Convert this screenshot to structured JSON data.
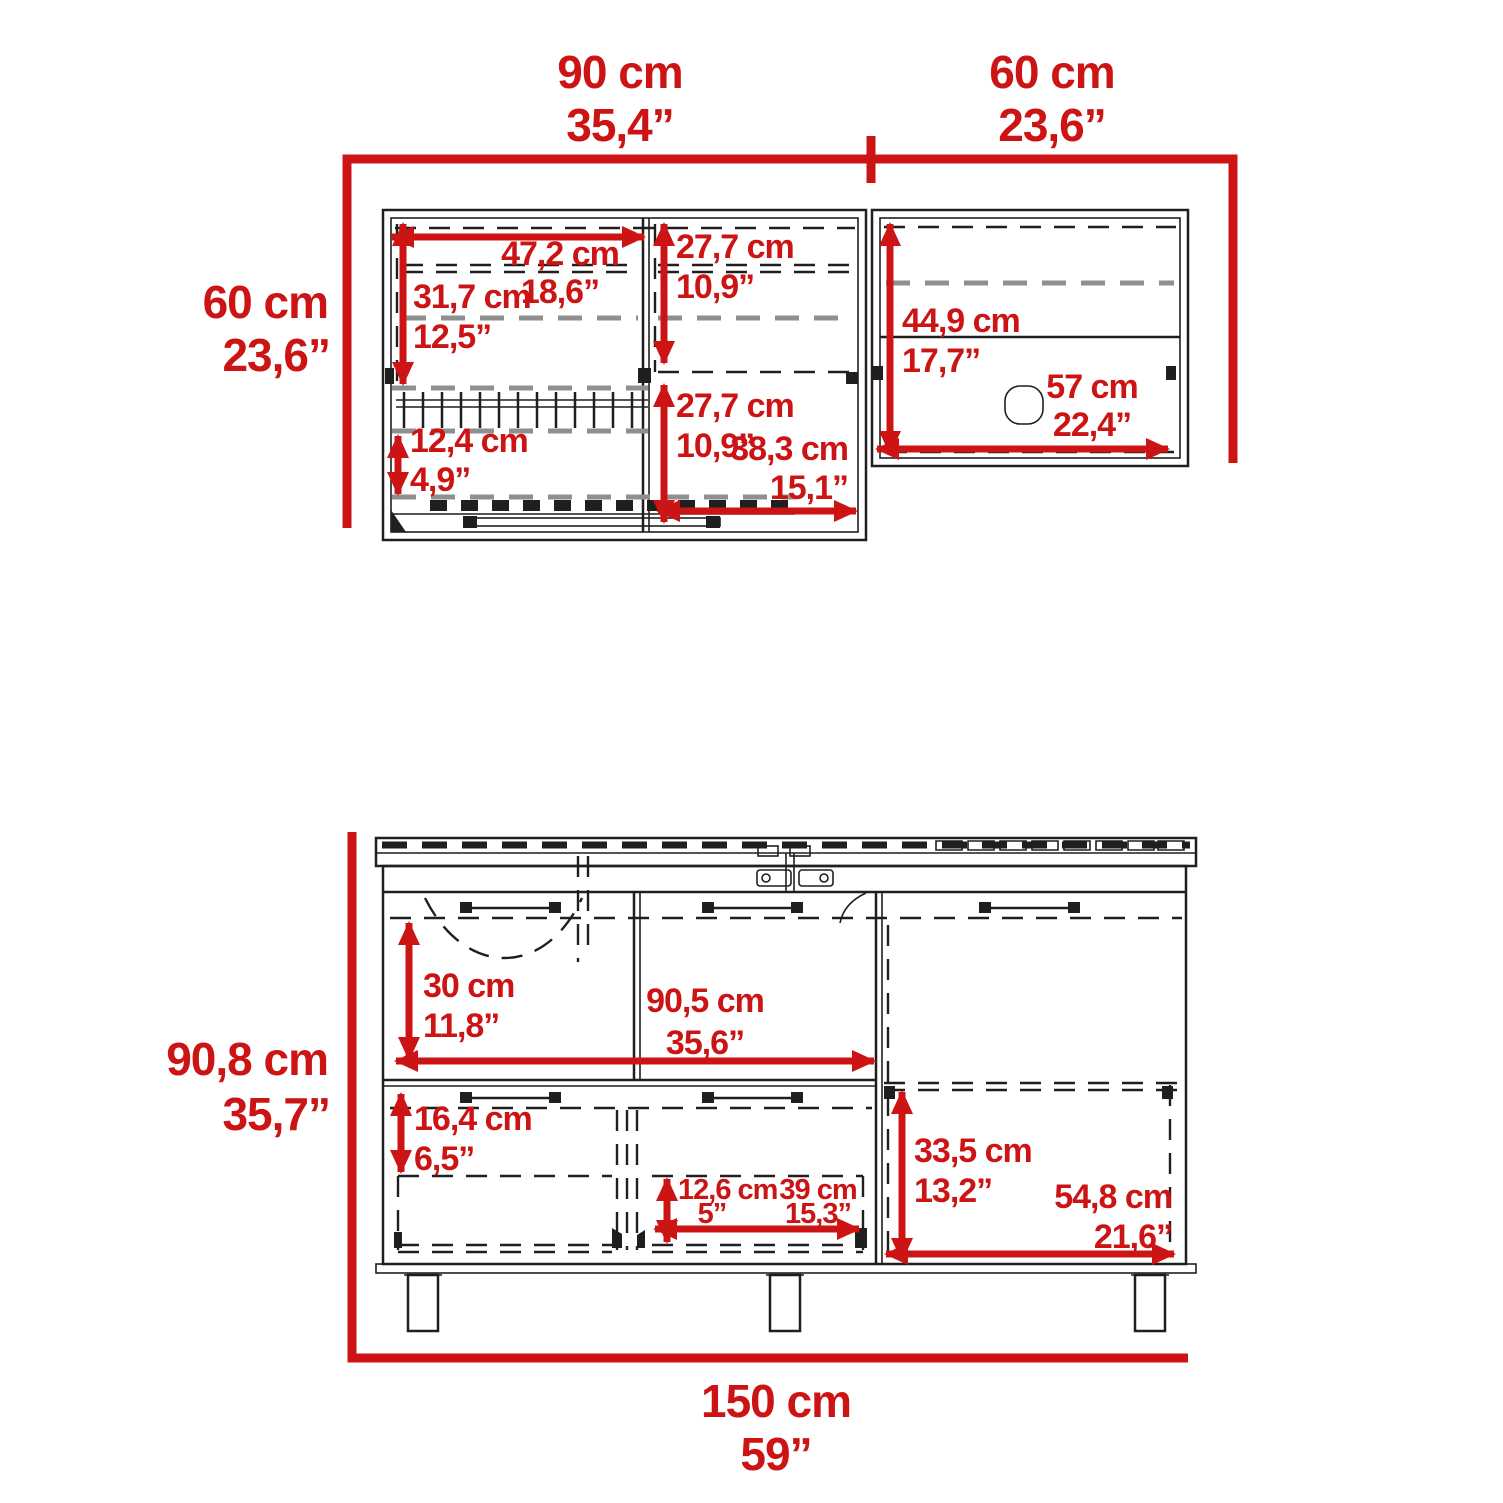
{
  "colors": {
    "accent": "#cc1414",
    "line": "#1f1f1f",
    "dash_gray": "#8f8f8f",
    "background": "#ffffff"
  },
  "upper_view": {
    "top_width_main": {
      "cm": "90 cm",
      "in": "35,4”"
    },
    "top_width_right": {
      "cm": "60 cm",
      "in": "23,6”"
    },
    "side_height": {
      "cm": "60 cm",
      "in": "23,6”"
    },
    "dims": {
      "interior_width": {
        "cm": "47,2 cm",
        "in": "18,6”"
      },
      "upper_section_height": {
        "cm": "31,7 cm",
        "in": "12,5”"
      },
      "upper_door_height": {
        "cm": "27,7 cm",
        "in": "10,9”"
      },
      "lower_door_height": {
        "cm": "27,7 cm",
        "in": "10,9”"
      },
      "rack_section_height": {
        "cm": "12,4 cm",
        "in": "4,9”"
      },
      "door_width": {
        "cm": "38,3 cm",
        "in": "15,1”"
      },
      "right_interior_height": {
        "cm": "44,9 cm",
        "in": "17,7”"
      },
      "right_interior_width": {
        "cm": "57 cm",
        "in": "22,4”"
      }
    }
  },
  "base_view": {
    "side_height": {
      "cm": "90,8 cm",
      "in": "35,7”"
    },
    "bottom_width": {
      "cm": "150 cm",
      "in": "59”"
    },
    "dims": {
      "top_section_height": {
        "cm": "30 cm",
        "in": "11,8”"
      },
      "interior_width": {
        "cm": "90,5 cm",
        "in": "35,6”"
      },
      "lower_left_height": {
        "cm": "16,4 cm",
        "in": "6,5”"
      },
      "inner_drawer_height": {
        "cm": "12,6 cm",
        "in": "5”"
      },
      "inner_drawer_width": {
        "cm": "39 cm",
        "in": "15,3”"
      },
      "right_door_height": {
        "cm": "33,5 cm",
        "in": "13,2”"
      },
      "right_door_width": {
        "cm": "54,8 cm",
        "in": "21,6”"
      }
    }
  }
}
